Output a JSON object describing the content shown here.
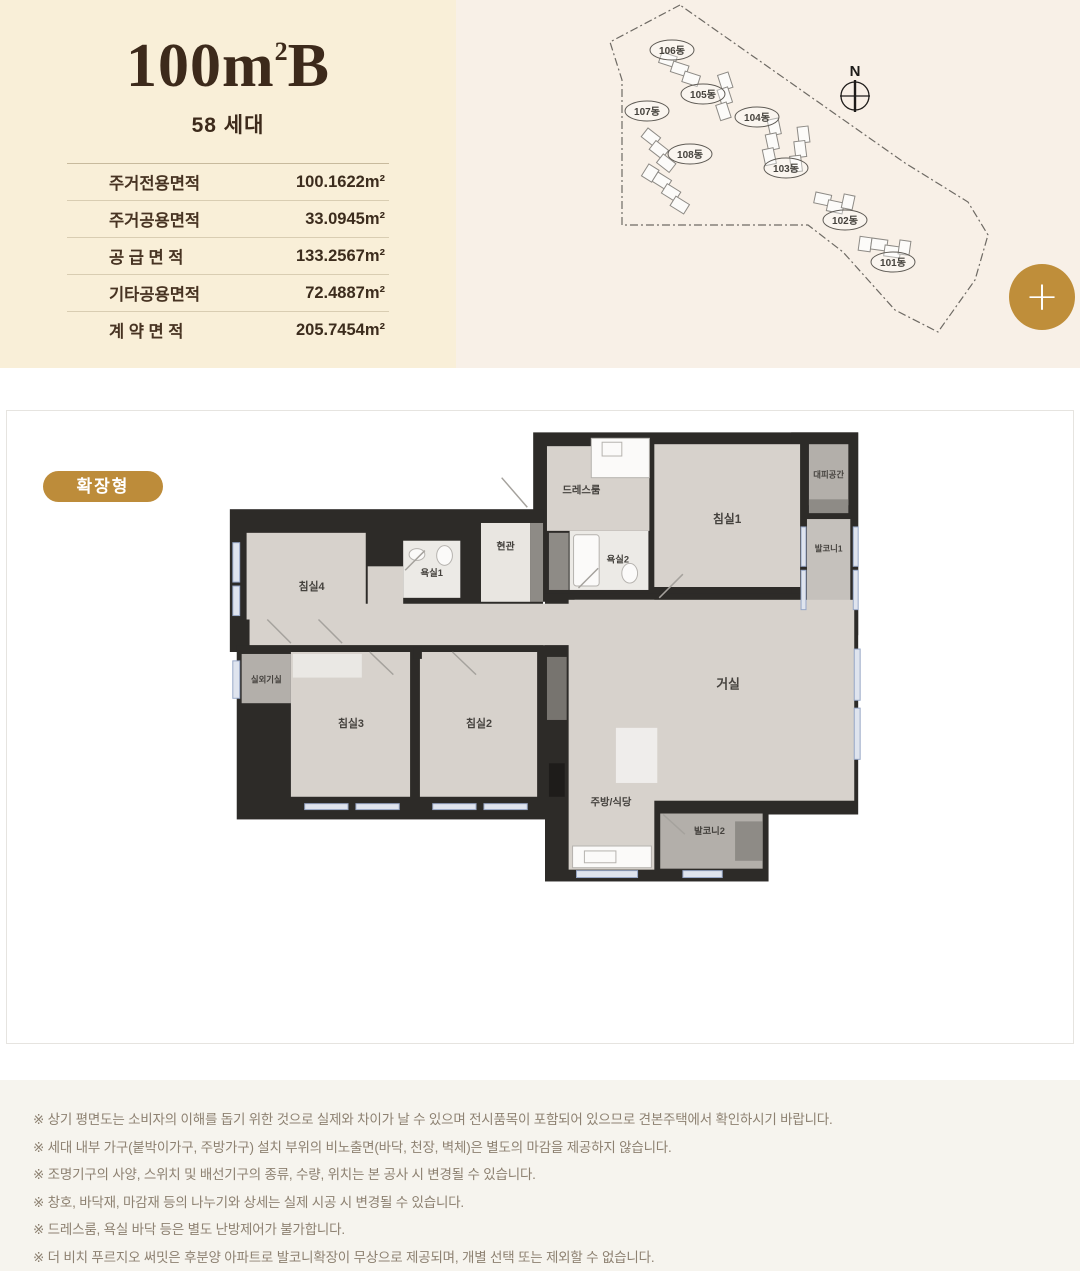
{
  "header": {
    "title_base": "100m",
    "title_sup": "2",
    "title_tail": "B",
    "unit_count": "58 세대",
    "area_table": [
      {
        "label": "주거전용면적",
        "value": "100.1622m²"
      },
      {
        "label": "주거공용면적",
        "value": "33.0945m²"
      },
      {
        "label": "공 급 면 적",
        "value": "133.2567m²"
      },
      {
        "label": "기타공용면적",
        "value": "72.4887m²"
      },
      {
        "label": "계 약 면 적",
        "value": "205.7454m²"
      }
    ]
  },
  "site_map": {
    "compass_label": "N",
    "buildings": [
      "106동",
      "105동",
      "107동",
      "104동",
      "108동",
      "103동",
      "102동",
      "101동"
    ],
    "highlight_color": "#ee86bb"
  },
  "toolbar": {
    "zoom_button_label": "+"
  },
  "plan": {
    "badge": "확장형",
    "rooms": {
      "dress": "드레스룸",
      "evac": "대피공간",
      "bed1": "침실1",
      "balc1": "발코니1",
      "bath2": "욕실2",
      "entry": "현관",
      "bath1": "욕실1",
      "bed4": "침실4",
      "outdoor": "실외기실",
      "bed3": "침실3",
      "bed2": "침실2",
      "living": "거실",
      "kitchen": "주방/식당",
      "balc2": "발코니2"
    }
  },
  "notes": {
    "items": [
      "※ 상기 평면도는 소비자의 이해를 돕기 위한 것으로 실제와 차이가 날 수 있으며 전시품목이 포함되어 있으므로 견본주택에서 확인하시기 바랍니다.",
      "※ 세대 내부 가구(붙박이가구, 주방가구) 설치 부위의 비노출면(바닥, 천장, 벽체)은 별도의 마감을 제공하지 않습니다.",
      "※ 조명기구의 사양, 스위치 및 배선기구의 종류, 수량, 위치는 본 공사 시 변경될 수 있습니다.",
      "※ 창호, 바닥재, 마감재 등의 나누기와 상세는 실제 시공 시 변경될 수 있습니다.",
      "※ 드레스룸, 욕실 바닥 등은 별도 난방제어가 불가합니다.",
      "※ 더 비치 푸르지오 써밋은 후분양 아파트로 발코니확장이 무상으로 제공되며, 개별 선택 또는 제외할 수 없습니다."
    ]
  }
}
